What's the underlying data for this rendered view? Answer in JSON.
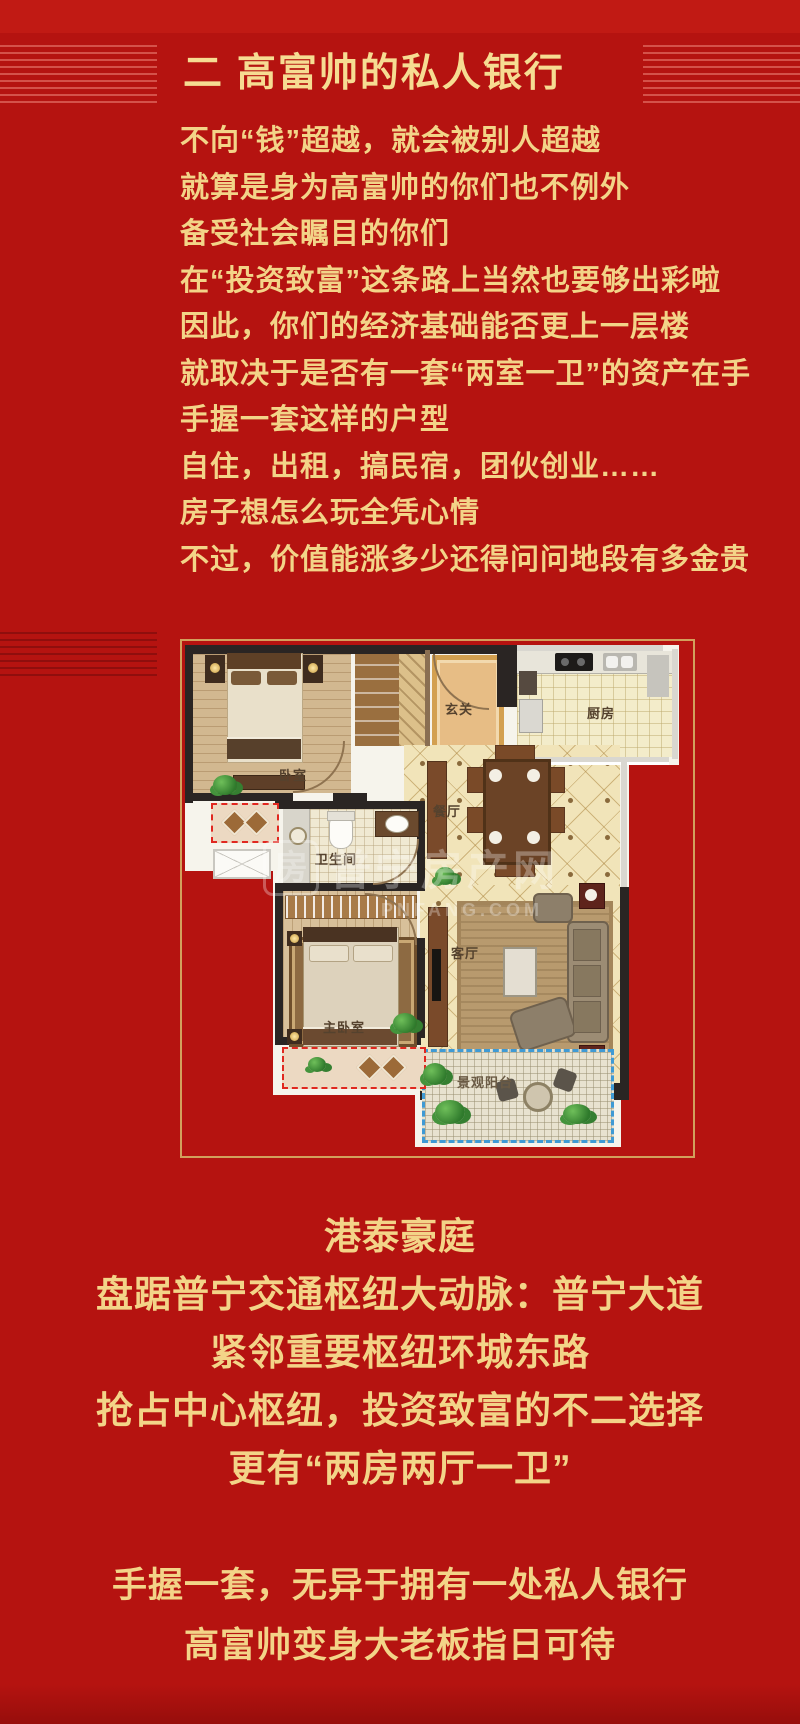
{
  "colors": {
    "background_red": "#b51310",
    "text_gold": "#f3d488",
    "frame_gold": "#d2a05c",
    "bay_window_dashed_red": "#e02820",
    "balcony_dashed_blue": "#3f9ad4"
  },
  "title": {
    "text": "二 高富帅的私人银行"
  },
  "intro": {
    "lines": [
      "不向“钱”超越，就会被别人超越",
      "就算是身为高富帅的你们也不例外",
      "备受社会瞩目的你们",
      "在“投资致富”这条路上当然也要够出彩啦",
      "因此，你们的经济基础能否更上一层楼",
      "就取决于是否有一套“两室一卫”的资产在手",
      "手握一套这样的户型",
      "自住，出租，搞民宿，团伙创业……",
      "房子想怎么玩全凭心情",
      "不过，价值能涨多少还得问问地段有多金贵"
    ]
  },
  "plan": {
    "labels": {
      "bedroom": "卧室",
      "entry": "玄关",
      "kitchen": "厨房",
      "dining": "餐厅",
      "bathroom": "卫生间",
      "living": "客厅",
      "master_bedroom": "主卧室",
      "balcony": "景观阳台"
    },
    "watermark": {
      "cn": "普宁房产网",
      "en": "PNFANG.COM"
    }
  },
  "highlight": {
    "lines": [
      "港泰豪庭",
      "盘踞普宁交通枢纽大动脉：普宁大道",
      "紧邻重要枢纽环城东路",
      "抢占中心枢纽，投资致富的不二选择",
      "更有“两房两厅一卫”"
    ]
  },
  "closing": {
    "lines": [
      "手握一套，无异于拥有一处私人银行",
      "高富帅变身大老板指日可待"
    ]
  }
}
